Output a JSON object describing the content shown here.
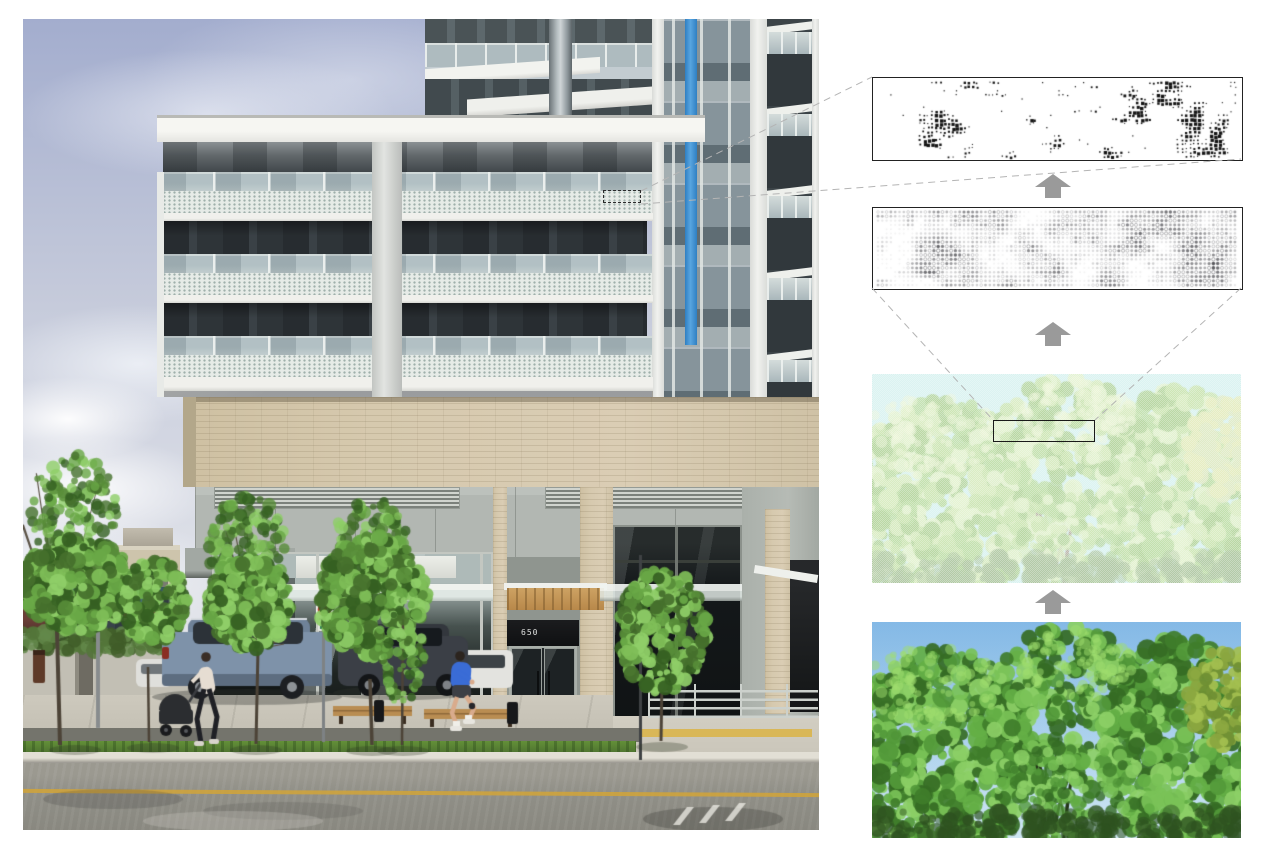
{
  "page": {
    "background": "#ffffff"
  },
  "photo": {
    "entrance": {
      "address_number": "650"
    },
    "annotation": {
      "style": "dashed-rectangle",
      "border": "#2b2b2b"
    },
    "palette": {
      "sky_top": "#a3adce",
      "sky_mid": "#c6cbdb",
      "sky_low": "#dadde6",
      "frit_glass": "#e6ebe7",
      "frit_dot": "#9fb0ab",
      "tower_glass": "#86949b",
      "tower_glass_dark": "#5f6d74",
      "tower_spandrel": "#a3aeb1",
      "accent_blue": "#3e8ed0",
      "beige_brick": "#d2c5a9",
      "podium_gray": "#b2b7b2",
      "storefront_glass": "#14181a",
      "wood_canopy": "#c09355",
      "grass": "#5c8038",
      "road": "#8f8e86",
      "lane_yellow": "#cda33e",
      "rail": "#ccd1cc",
      "tactile": "#d9b757",
      "foliage": [
        "#45702c",
        "#578c38",
        "#69a846",
        "#7fbe58",
        "#356022",
        "#8fce68"
      ],
      "trunk": "#4c4337",
      "car_blue_gray": "#7e92a9",
      "car_dark": "#3b3f46",
      "car_white": "#e3e3df",
      "jogger_jacket": "#3a6cd6",
      "skin": "#d9ab8c",
      "bench_wood": "#b98d52",
      "sign_red": "#c23227"
    }
  },
  "process_column": {
    "arrow_color": "#9a9a9a",
    "leader_line_color": "#b4b4b4",
    "panels": [
      {
        "id": "frit-dot-pattern",
        "kind": "bw-dot-pattern",
        "background": "#ffffff",
        "dot_color": "#141414",
        "border": "#222222"
      },
      {
        "id": "halftone-dot-pattern",
        "kind": "gray-dot-pattern",
        "background": "#ffffff",
        "dot_color": "40,40,46",
        "border": "#222222"
      },
      {
        "id": "dithered-tree-image",
        "kind": "dithered-photo",
        "sky": "#c6ecea",
        "palette": [
          "#b2d98c",
          "#c6e3a2",
          "#a0cf7e",
          "#d6ecb8",
          "#8fc06e"
        ],
        "selection_outline": "#1a1a1a"
      },
      {
        "id": "tree-photo",
        "kind": "photo",
        "sky_top": "#84b9e6",
        "sky_bottom": "#cfe6f3",
        "palette": [
          "#3f7d2a",
          "#52993a",
          "#64af45",
          "#79c257",
          "#8ccf66",
          "#356b24"
        ]
      }
    ]
  }
}
